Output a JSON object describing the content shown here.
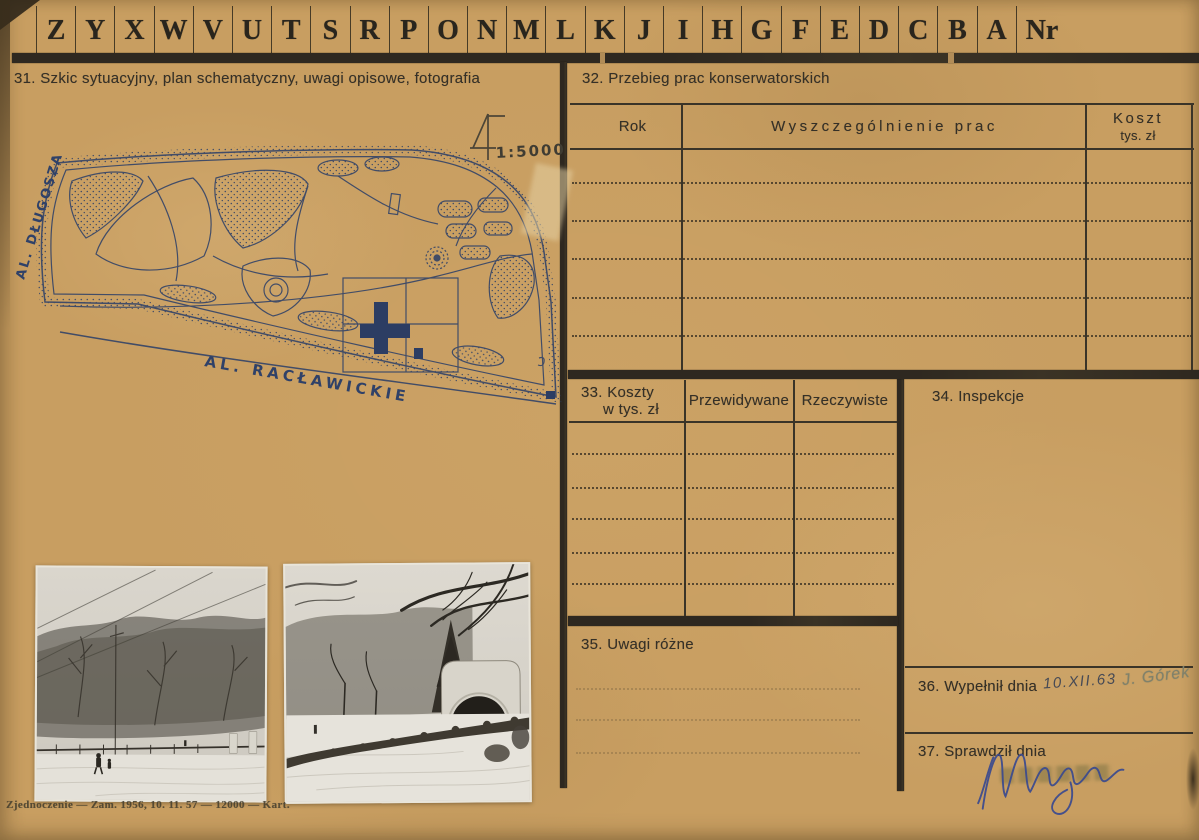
{
  "header": {
    "letters": [
      "Z",
      "Y",
      "X",
      "W",
      "V",
      "U",
      "T",
      "S",
      "R",
      "P",
      "O",
      "N",
      "M",
      "L",
      "K",
      "J",
      "I",
      "H",
      "G",
      "F",
      "E",
      "D",
      "C",
      "B",
      "A"
    ],
    "nr_label": "Nr"
  },
  "sections": {
    "s31": {
      "title": "31. Szkic sytuacyjny, plan schematyczny, uwagi opisowe, fotografia"
    },
    "s32": {
      "title": "32. Przebieg prac konserwatorskich",
      "columns": {
        "rok": "Rok",
        "works": "Wyszczególnienie prac",
        "cost_line1": "Koszt",
        "cost_line2": "tys. zł"
      }
    },
    "s33": {
      "title_line1": "33. Koszty",
      "title_line2": "w tys. zł",
      "col_planned": "Przewidywane",
      "col_actual": "Rzeczywiste"
    },
    "s34": {
      "title": "34. Inspekcje"
    },
    "s35": {
      "title": "35. Uwagi różne"
    },
    "s36": {
      "title": "36. Wypełnił dnia",
      "handwritten_date": "10.XII.63",
      "handwritten_name": "J. Górek"
    },
    "s37": {
      "title": "37. Sprawdził dnia"
    }
  },
  "map": {
    "scale_label": "1:5000",
    "street_left": "AL. DŁUGOSZA",
    "street_bottom": "AL. RACŁAWICKIE"
  },
  "footer": {
    "imprint": "Zjednoczenie — Zam. 1956, 10. 11. 57 — 12000 — Kart."
  },
  "photos": {
    "left_name": "winter-street-with-trees-photo",
    "right_name": "park-band-shell-in-snow-photo"
  },
  "colors": {
    "card": "#c89e61",
    "ink": "#353027",
    "map_ink": "#2f4168",
    "signature_ink": "#3a4a8f"
  }
}
